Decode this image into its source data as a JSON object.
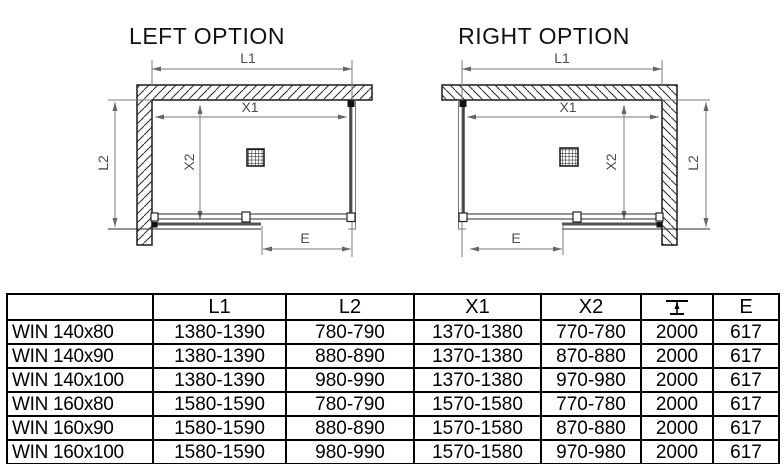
{
  "colors": {
    "background": "#ffffff",
    "drawing_line": "#1a1a1a",
    "dimension_line": "#7a7a7a",
    "dimension_label": "#4d4d4d",
    "table_border": "#000000"
  },
  "diagrams": {
    "left": {
      "title": "LEFT OPTION",
      "labels": {
        "l1": "L1",
        "x1": "X1",
        "x2": "X2",
        "l2": "L2",
        "e": "E"
      },
      "icons": [
        "wall-hatch",
        "drain-grate-icon",
        "sliding-door",
        "fixed-glass-panel"
      ]
    },
    "right": {
      "title": "RIGHT OPTION",
      "labels": {
        "l1": "L1",
        "x1": "X1",
        "x2": "X2",
        "l2": "L2",
        "e": "E"
      },
      "icons": [
        "wall-hatch",
        "drain-grate-icon",
        "sliding-door",
        "fixed-glass-panel"
      ]
    }
  },
  "table": {
    "header": {
      "model": "",
      "l1": "L1",
      "l2": "L2",
      "x1": "X1",
      "x2": "X2",
      "height_icon": "height-dimension-icon",
      "e": "E"
    },
    "rows": [
      {
        "name": "WIN 140x80",
        "l1": "1380-1390",
        "l2": "780-790",
        "x1": "1370-1380",
        "x2": "770-780",
        "h": "2000",
        "e": "617"
      },
      {
        "name": "WIN 140x90",
        "l1": "1380-1390",
        "l2": "880-890",
        "x1": "1370-1380",
        "x2": "870-880",
        "h": "2000",
        "e": "617"
      },
      {
        "name": "WIN 140x100",
        "l1": "1380-1390",
        "l2": "980-990",
        "x1": "1370-1380",
        "x2": "970-980",
        "h": "2000",
        "e": "617"
      },
      {
        "name": "WIN 160x80",
        "l1": "1580-1590",
        "l2": "780-790",
        "x1": "1570-1580",
        "x2": "770-780",
        "h": "2000",
        "e": "617"
      },
      {
        "name": "WIN 160x90",
        "l1": "1580-1590",
        "l2": "880-890",
        "x1": "1570-1580",
        "x2": "870-880",
        "h": "2000",
        "e": "617"
      },
      {
        "name": "WIN 160x100",
        "l1": "1580-1590",
        "l2": "980-990",
        "x1": "1570-1580",
        "x2": "970-980",
        "h": "2000",
        "e": "617"
      }
    ]
  }
}
